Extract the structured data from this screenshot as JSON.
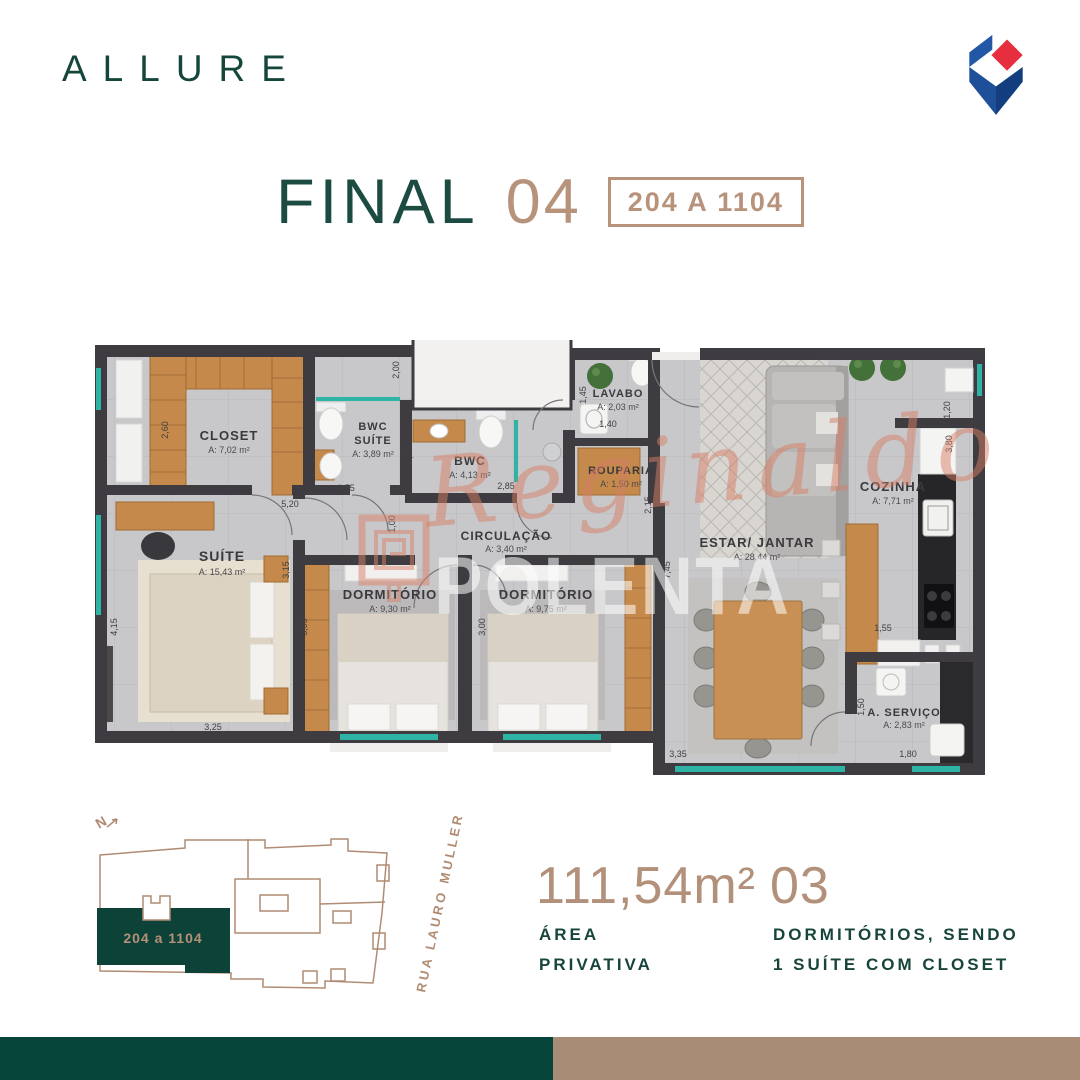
{
  "brand": {
    "name": "ALLURE"
  },
  "title": {
    "label": "FINAL",
    "number": "04",
    "badge": "204 A 1104"
  },
  "plan": {
    "rooms": [
      {
        "name": "CLOSET",
        "area": "A: 7,02 m²"
      },
      {
        "name": "BWC",
        "name2": "SUÍTE",
        "area": "A: 3,89 m²"
      },
      {
        "name": "BWC",
        "area": "A: 4,13 m²"
      },
      {
        "name": "LAVABO",
        "area": "A: 2,03 m²"
      },
      {
        "name": "ROUPARIA",
        "area": "A: 1,50 m²"
      },
      {
        "name": "CIRCULAÇÃO",
        "area": "A: 3,40 m²"
      },
      {
        "name": "SUÍTE",
        "area": "A: 15,43 m²"
      },
      {
        "name": "DORMITÓRIO",
        "area": "A: 9,30 m²"
      },
      {
        "name": "DORMITÓRIO",
        "area": "A: 9,75 m²"
      },
      {
        "name": "ESTAR/ JANTAR",
        "area": "A: 28,44 m²"
      },
      {
        "name": "COZINHA",
        "area": "A: 7,71 m²"
      },
      {
        "name": "A. SERVIÇO",
        "area": "A: 2,83 m²"
      }
    ],
    "dims": [
      "2,70",
      "2,60",
      "5,20",
      "1,55",
      "2,00",
      "1,45",
      "2,85",
      "1,45",
      "1,40",
      "2,15",
      "5,30",
      "1,20",
      "3,80",
      "4,15",
      "3,15",
      "3,25",
      "3,00",
      "1,00",
      "3,00",
      "7,45",
      "1,55",
      "1,50",
      "3,35",
      "1,80"
    ]
  },
  "watermark": {
    "script": "Reginaldo",
    "block": "POLENTA"
  },
  "siteplan": {
    "north": "N",
    "unit": "204 a 1104",
    "street": "RUA LAURO MULLER"
  },
  "summary": {
    "area_value": "111,54m²",
    "area_l1": "ÁREA",
    "area_l2": "PRIVATIVA",
    "dorm_value": "03",
    "dorm_l1": "DORMITÓRIOS, SENDO",
    "dorm_l2": "1 SUÍTE COM CLOSET"
  },
  "colors": {
    "accent_green": "#17453c",
    "accent_tan": "#b3907a",
    "site_green": "#0c4237",
    "teal": "#2fb3a6",
    "wall": "#3e3c40",
    "bar_green": "#05453a",
    "bar_tan": "#a98c76"
  }
}
